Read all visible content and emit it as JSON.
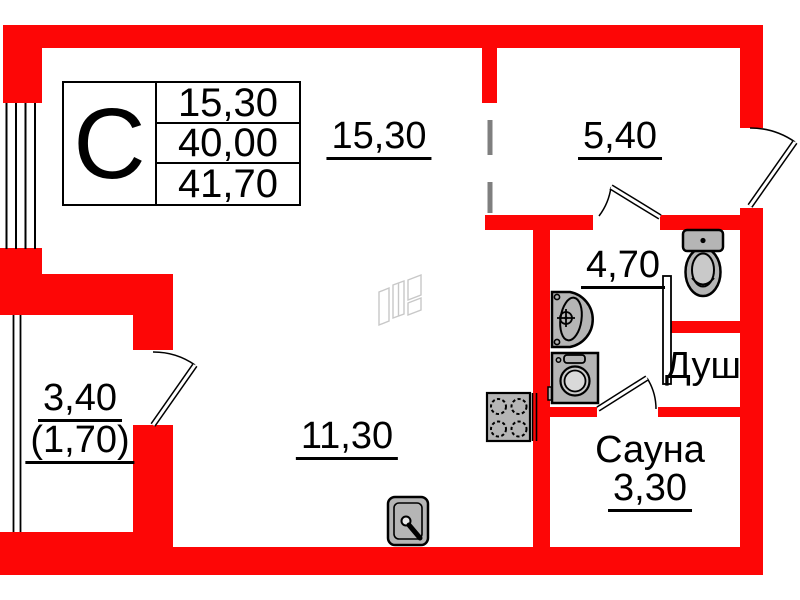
{
  "plan": {
    "type": "apartment-floor-plan",
    "compass_section": "С",
    "info_table": {
      "rows": [
        {
          "name": "living-area",
          "value": "15,30"
        },
        {
          "name": "floor-area",
          "value": "40,00"
        },
        {
          "name": "total-area",
          "value": "41,70"
        }
      ]
    },
    "labels": {
      "room_main_upper": "15,30",
      "room_kitchen": "5,40",
      "room_bathroom": "4,70",
      "shower": "Душ",
      "sauna_name": "Сауна",
      "sauna_area": "3,30",
      "room_main_lower": "11,30",
      "balcony_area": "3,40",
      "balcony_area_reduced": "(1,70)"
    },
    "fixtures": [
      {
        "name": "toilet-icon"
      },
      {
        "name": "wash-basin-icon"
      },
      {
        "name": "washing-machine-icon"
      },
      {
        "name": "gas-stove-icon"
      },
      {
        "name": "kitchen-sink-icon"
      }
    ],
    "colors": {
      "wall": "#fd0606",
      "fixture_fill": "#b5b5b5",
      "fixture_inner": "#c9c9c9",
      "dashed_partition": "#7f7f7f",
      "watermark": "#c8c8c8",
      "line": "#000000"
    }
  }
}
